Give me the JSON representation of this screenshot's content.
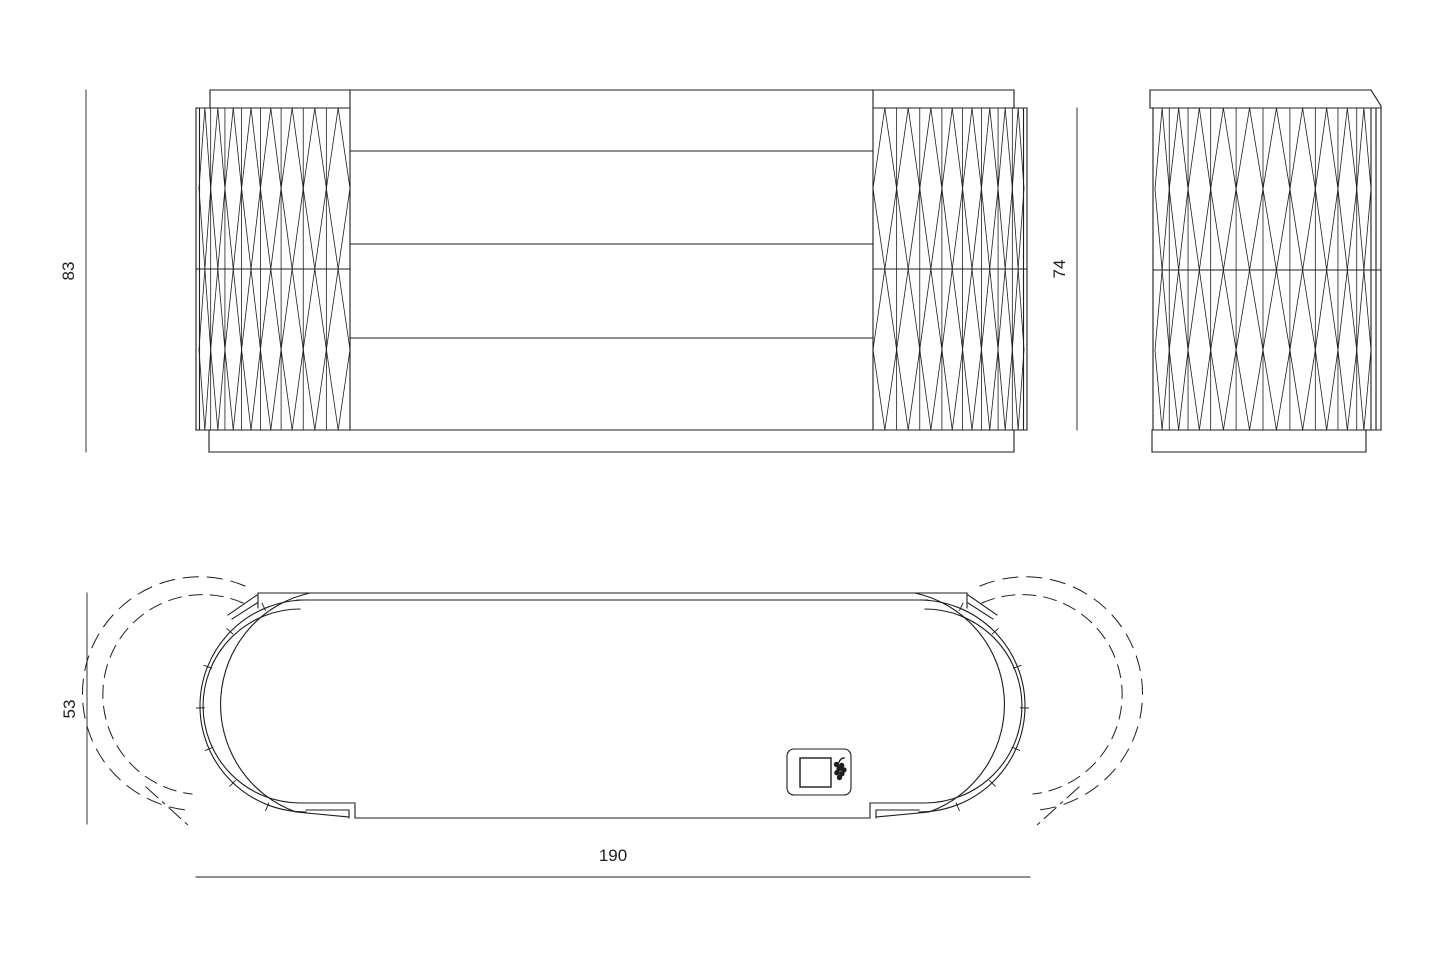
{
  "document": {
    "type": "furniture-technical-drawing",
    "background": "#ffffff"
  },
  "views": {
    "front": {
      "name": "front-elevation"
    },
    "side": {
      "name": "side-elevation"
    },
    "plan": {
      "name": "plan-view-with-door-swing"
    }
  },
  "dimensions": {
    "overall_height": "83",
    "body_height": "74",
    "depth": "53",
    "width": "190"
  },
  "icons": {
    "logo": "grapes-logo-icon"
  },
  "colors": {
    "line": "#1d1d1b",
    "background": "#ffffff"
  }
}
